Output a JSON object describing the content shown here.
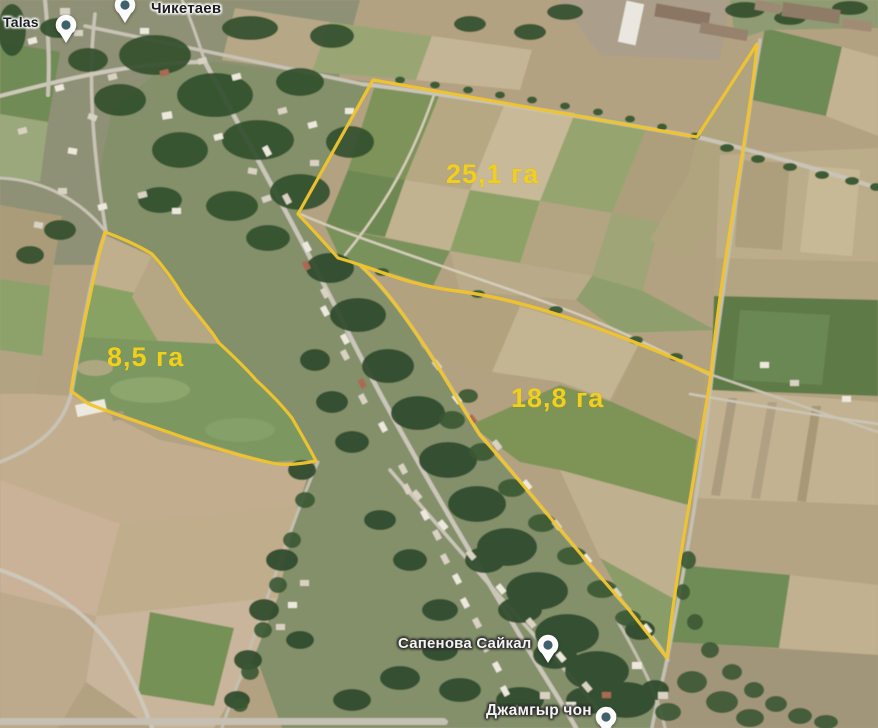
{
  "map": {
    "imagery": "satellite",
    "outline_color": "#efc42f",
    "area_label_color": "#f1d01d"
  },
  "parcels": [
    {
      "area_label": "25,1 га"
    },
    {
      "area_label": "8,5 га"
    },
    {
      "area_label": "18,8 га"
    }
  ],
  "places": [
    {
      "name": "Talas"
    },
    {
      "name": "Чикетаев"
    },
    {
      "name": "Сапенова Сайкал"
    },
    {
      "name": "Джамгыр чон"
    }
  ]
}
